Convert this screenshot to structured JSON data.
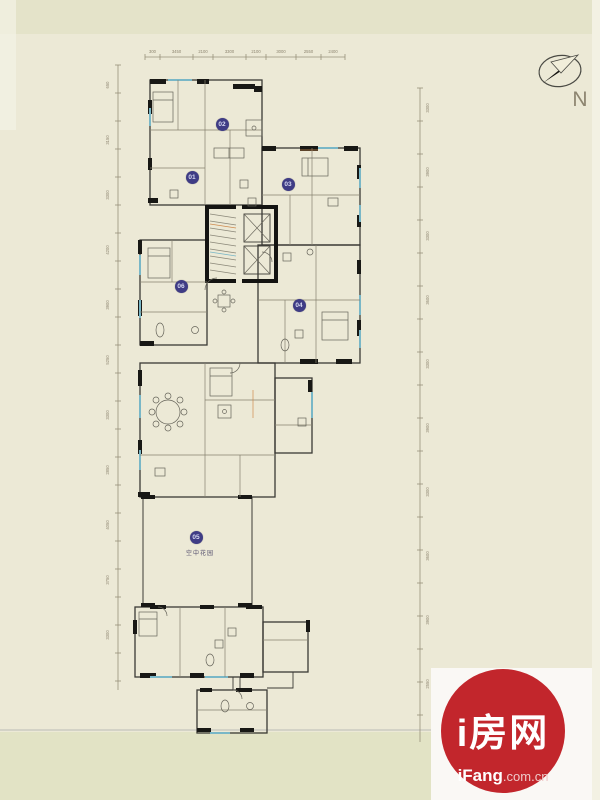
{
  "compass": {
    "label": "N"
  },
  "logo": {
    "title": "i房网",
    "brand": "iFang",
    "suffix": ".com.cn",
    "red": "#c2262c"
  },
  "plan": {
    "marker_color": "#3f3c85",
    "units": [
      {
        "id": "02",
        "x": 222,
        "y": 124
      },
      {
        "id": "01",
        "x": 192,
        "y": 177
      },
      {
        "id": "03",
        "x": 288,
        "y": 184
      },
      {
        "id": "06",
        "x": 181,
        "y": 286
      },
      {
        "id": "04",
        "x": 299,
        "y": 305
      },
      {
        "id": "05",
        "x": 196,
        "y": 537
      }
    ],
    "garden_label": {
      "text": "空中花园"
    }
  },
  "dimensions": {
    "top_labels": [
      "300",
      "3450",
      "2100",
      "3300",
      "2100",
      "3000",
      "2550",
      "2400"
    ],
    "left_labels": [
      "650",
      "3150",
      "3300",
      "4200",
      "3900",
      "5250",
      "3300",
      "2850",
      "4050",
      "3750",
      "3300"
    ],
    "right_labels": [
      "3300",
      "3900",
      "3300",
      "3600",
      "3300",
      "3900",
      "3300",
      "3600",
      "3900",
      "2550"
    ]
  }
}
